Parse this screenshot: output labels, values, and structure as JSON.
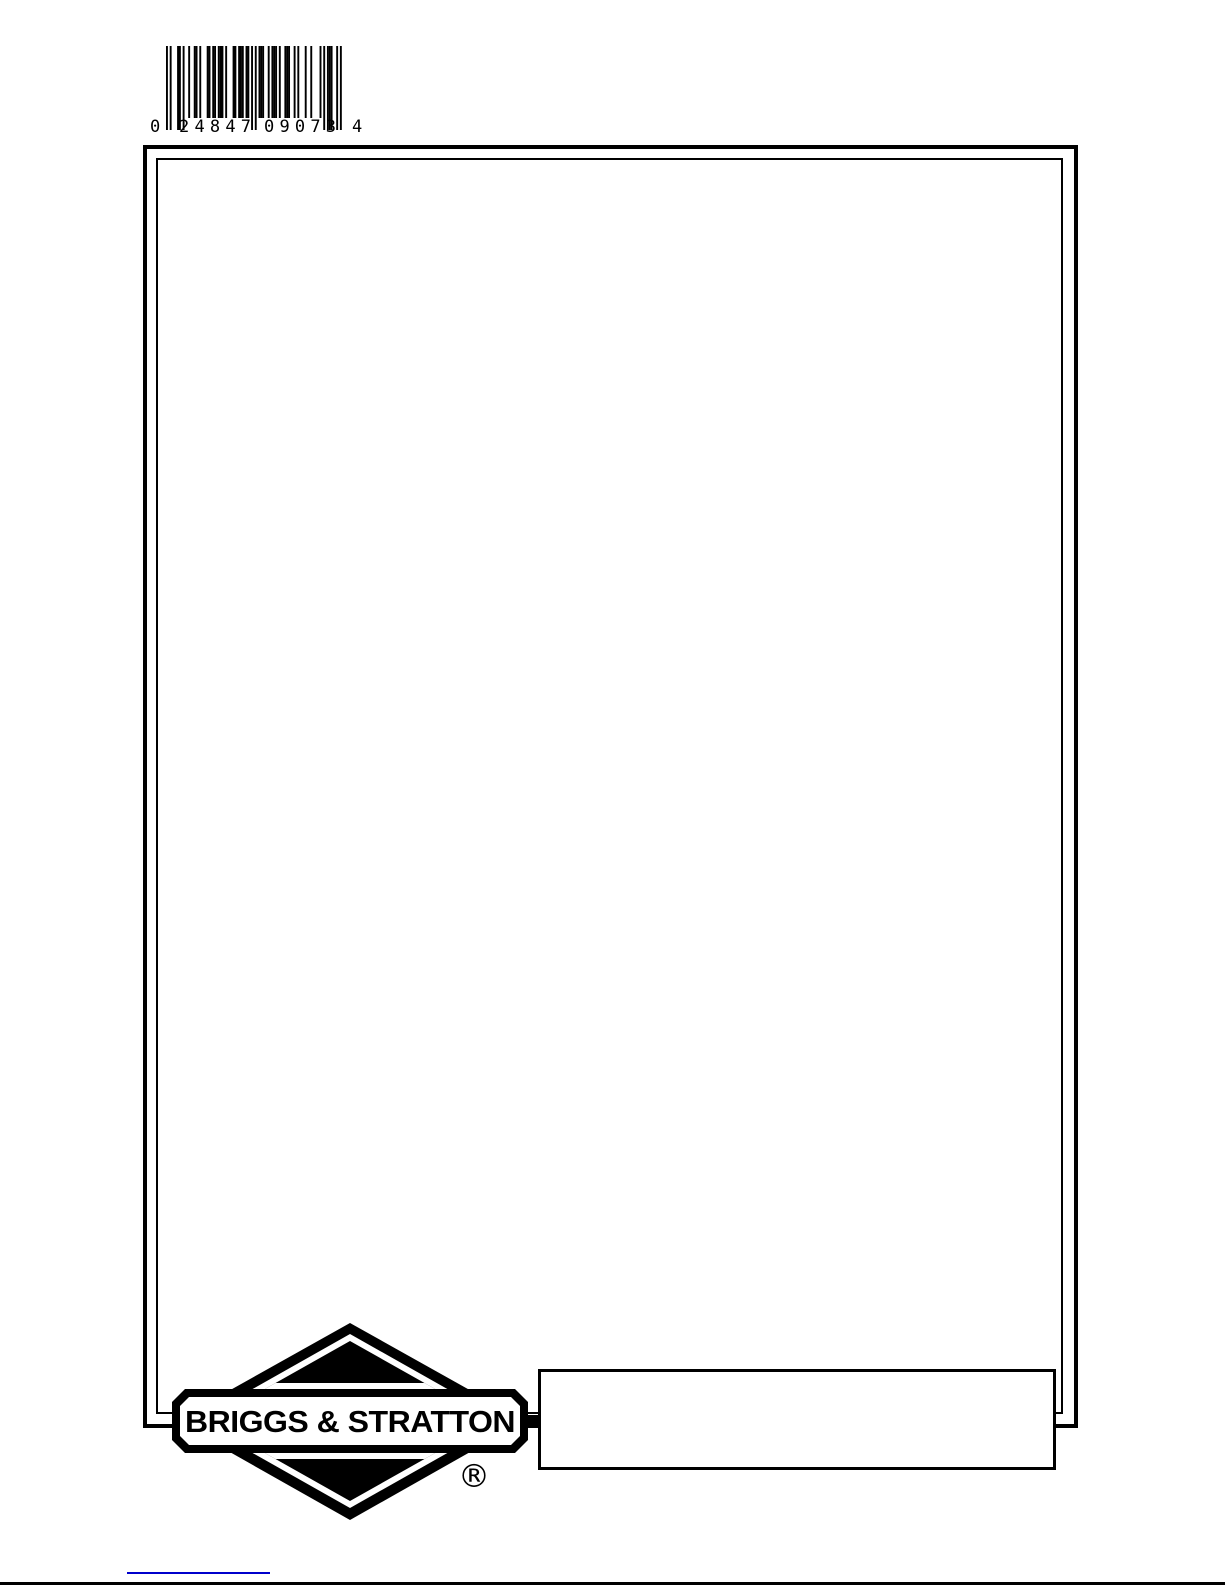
{
  "page": {
    "background_color": "#ffffff",
    "ink_color": "#000000"
  },
  "barcode": {
    "symbology": "UPC-A",
    "digits": "024847090734",
    "display": {
      "number_system_digit": "0",
      "left_group": "24847",
      "right_group": "09073",
      "check_digit": "4"
    }
  },
  "logo": {
    "brand": "BRIGGS & STRATTON",
    "registered_mark": "®"
  },
  "footer": {
    "info_box_text": ""
  },
  "accents": {
    "blue_line_color": "#0000cc"
  }
}
